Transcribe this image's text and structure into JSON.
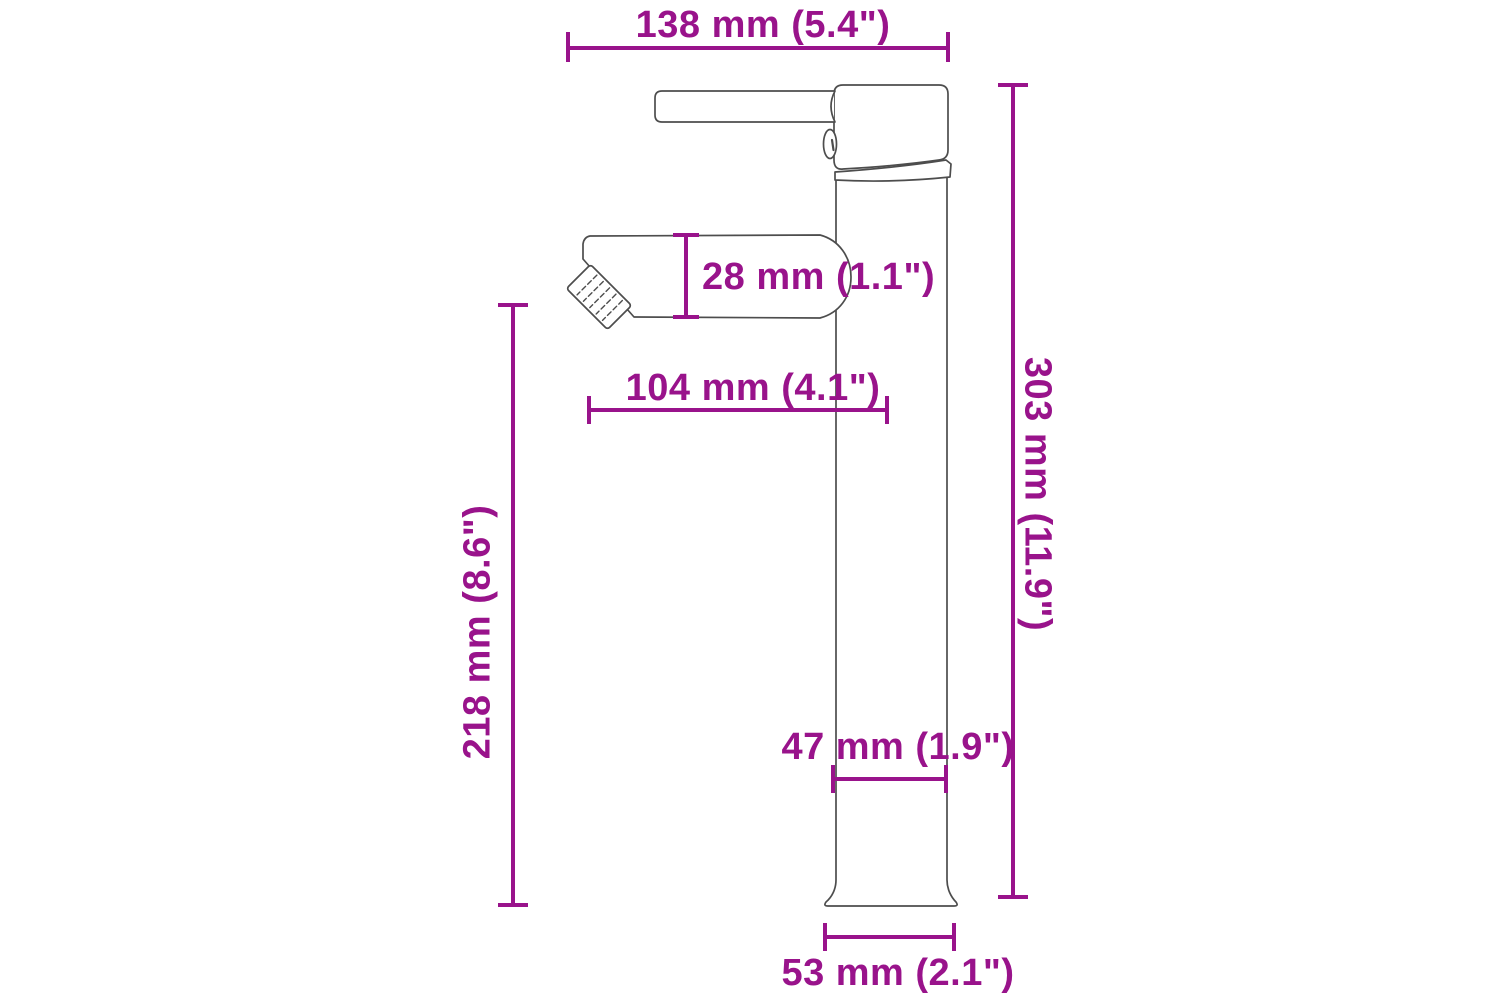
{
  "colors": {
    "accent": "#99138b",
    "outline": "#4d4d4d",
    "background": "#ffffff"
  },
  "diagram": {
    "subject": "faucet-side-view",
    "dimensions": {
      "total_depth": {
        "label": "138 mm (5.4\")",
        "mm": 138,
        "inches": 5.4
      },
      "spout_height": {
        "label": "28 mm (1.1\")",
        "mm": 28,
        "inches": 1.1
      },
      "spout_reach": {
        "label": "104 mm (4.1\")",
        "mm": 104,
        "inches": 4.1
      },
      "height_to_spout": {
        "label": "218 mm (8.6\")",
        "mm": 218,
        "inches": 8.6
      },
      "total_height": {
        "label": "303 mm (11.9\")",
        "mm": 303,
        "inches": 11.9
      },
      "body_width": {
        "label": "47 mm (1.9\")",
        "mm": 47,
        "inches": 1.9
      },
      "base_width": {
        "label": "53 mm (2.1\")",
        "mm": 53,
        "inches": 2.1
      }
    }
  }
}
